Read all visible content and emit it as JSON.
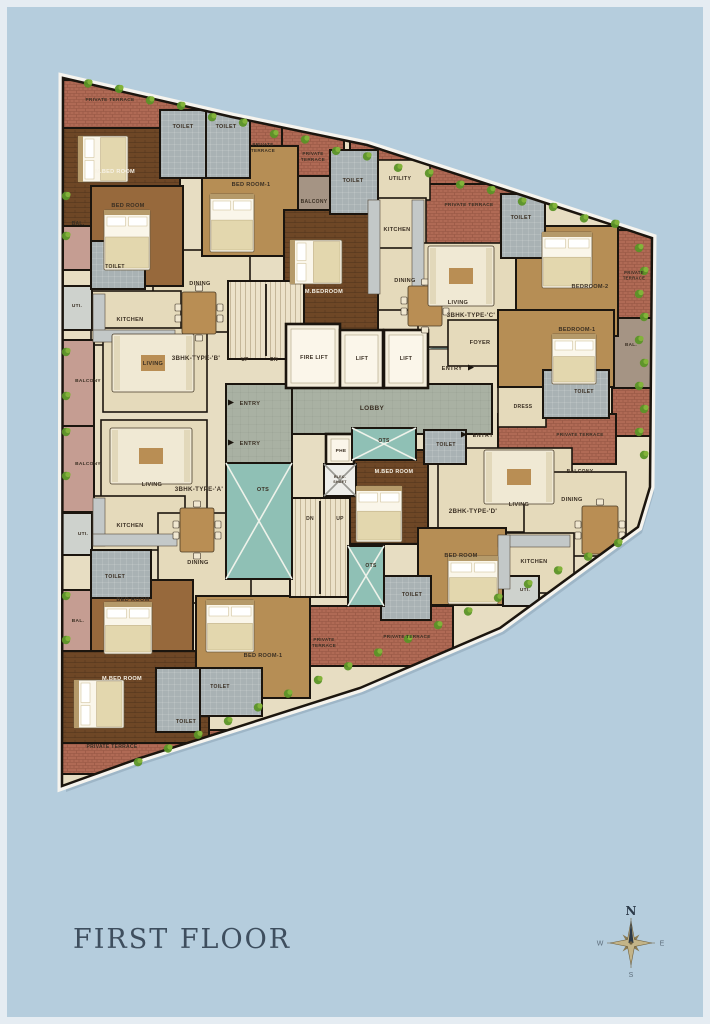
{
  "title": "FIRST FLOOR",
  "entry_label": "ENTRY",
  "compass": {
    "n": "N",
    "e": "E",
    "s": "S",
    "w": "W"
  },
  "colors": {
    "bg": "#b5cddd",
    "frame": "#e5ecf2",
    "slab": "#f6f4ee",
    "wall": "#1b150e",
    "base": "#e7ddc2",
    "terrace": "#b06a55",
    "terraceLine": "#935341",
    "toilet": "#a9b2b4",
    "lobby": "#a9b1a3",
    "lift": "#f4eddb",
    "ots": "#8fc0b5",
    "shaft": "#eeeeea",
    "stairs": "#ece2c9",
    "floor": "#e5dabb",
    "tan": "#b68e55",
    "brown": "#97693c",
    "wood": "#6e4726",
    "balc": "#c59d92",
    "balc2": "#a59484",
    "uti": "#ced2cd",
    "counter": "#c3c8c8",
    "mat": "#9fc8c0",
    "text": "#3a2f23",
    "textLight": "#f7f2e6",
    "title": "#3e4e5e",
    "green1": "#5b9427",
    "green2": "#83b33a",
    "compassStar": "#c3b488",
    "compassStar2": "#8a7a52",
    "compassDark": "#2c3a49",
    "compassSmall": "#5d6d7b"
  },
  "plan": {
    "outline": [
      [
        63,
        78
      ],
      [
        232,
        117
      ],
      [
        367,
        145
      ],
      [
        512,
        192
      ],
      [
        652,
        238
      ],
      [
        650,
        487
      ],
      [
        638,
        527
      ],
      [
        500,
        628
      ],
      [
        360,
        688
      ],
      [
        140,
        758
      ],
      [
        62,
        786
      ]
    ],
    "rooms": [
      [
        "terrace-top-left",
        "terrace",
        62,
        80,
        200,
        50
      ],
      [
        "terrace-top-2",
        "terrace",
        236,
        116,
        54,
        66
      ],
      [
        "terrace-top-3",
        "terrace",
        282,
        122,
        62,
        60
      ],
      [
        "terrace-top-mid",
        "terrace",
        350,
        135,
        175,
        60
      ],
      [
        "terrace-c",
        "terrace",
        424,
        184,
        96,
        60
      ],
      [
        "terrace-right-1",
        "terrace",
        614,
        230,
        38,
        92
      ],
      [
        "terrace-right-2",
        "terrace",
        612,
        386,
        40,
        50
      ],
      [
        "terrace-mid-right",
        "terrace",
        498,
        414,
        118,
        50
      ],
      [
        "terrace-bottom-center",
        "terrace",
        288,
        606,
        165,
        60
      ],
      [
        "terrace-bottom-left",
        "terrace",
        62,
        730,
        185,
        44
      ],
      [
        "lobby-main",
        "lobby",
        226,
        384,
        266,
        50
      ],
      [
        "lobby-left",
        "lobby",
        226,
        384,
        66,
        132
      ],
      [
        "entry-mat",
        "mat",
        428,
        336,
        34,
        13
      ],
      [
        "dining-b",
        "floor",
        153,
        250,
        97,
        82
      ],
      [
        "kitchen-b",
        "floor",
        91,
        291,
        90,
        54
      ],
      [
        "living-b",
        "floor",
        103,
        328,
        104,
        84
      ],
      [
        "balcony-b",
        "balc2",
        286,
        176,
        60,
        54
      ],
      [
        "utility-c",
        "floor",
        366,
        160,
        64,
        40
      ],
      [
        "kitchen-c",
        "floor",
        366,
        198,
        60,
        100
      ],
      [
        "dining-c",
        "floor",
        376,
        248,
        62,
        62
      ],
      [
        "living-c",
        "floor",
        418,
        243,
        104,
        104
      ],
      [
        "foyer-c",
        "floor",
        448,
        320,
        66,
        46
      ],
      [
        "dress-c",
        "floor",
        498,
        385,
        48,
        42
      ],
      [
        "living-d",
        "floor",
        438,
        448,
        134,
        84
      ],
      [
        "dining-d",
        "floor",
        524,
        472,
        102,
        84
      ],
      [
        "kitchen-d",
        "floor",
        496,
        533,
        78,
        60
      ],
      [
        "living-a",
        "floor",
        101,
        420,
        106,
        90
      ],
      [
        "kitchen-a",
        "floor",
        91,
        496,
        94,
        54
      ],
      [
        "dining-a",
        "floor",
        158,
        513,
        93,
        90
      ],
      [
        "bal-b",
        "balc",
        62,
        190,
        30,
        80
      ],
      [
        "balcony-left-1",
        "balc",
        62,
        340,
        32,
        86
      ],
      [
        "balcony-left-2",
        "balc",
        62,
        426,
        32,
        86
      ],
      [
        "bal-a",
        "balc",
        62,
        590,
        30,
        74
      ],
      [
        "bal-right",
        "balc2",
        612,
        318,
        40,
        70
      ],
      [
        "mbed-b",
        "wood",
        62,
        128,
        118,
        98
      ],
      [
        "bed1-b",
        "tan",
        202,
        146,
        96,
        110
      ],
      [
        "bed-b",
        "brown",
        91,
        186,
        92,
        100
      ],
      [
        "mbed-c",
        "wood",
        284,
        210,
        94,
        120
      ],
      [
        "bed2-c",
        "tan",
        516,
        226,
        102,
        110
      ],
      [
        "bed1-c",
        "tan",
        498,
        310,
        116,
        77
      ],
      [
        "mbed-d",
        "wood",
        350,
        450,
        78,
        94
      ],
      [
        "bed-d",
        "tan",
        418,
        528,
        88,
        77
      ],
      [
        "bed-a",
        "brown",
        91,
        580,
        102,
        87
      ],
      [
        "mbed-a",
        "wood",
        62,
        651,
        147,
        92
      ],
      [
        "bed1-a",
        "tan",
        196,
        596,
        114,
        102
      ],
      [
        "uti-b",
        "uti",
        62,
        286,
        30,
        44
      ],
      [
        "uti-a",
        "uti",
        62,
        513,
        30,
        42
      ],
      [
        "uti-d",
        "uti",
        503,
        576,
        36,
        30
      ],
      [
        "toilet-b1",
        "toilet",
        160,
        110,
        46,
        68
      ],
      [
        "toilet-b2",
        "toilet",
        206,
        110,
        44,
        68
      ],
      [
        "toilet-c1",
        "toilet",
        330,
        150,
        48,
        64
      ],
      [
        "toilet-b4",
        "toilet",
        91,
        241,
        54,
        48
      ],
      [
        "toilet-c2",
        "toilet",
        501,
        194,
        44,
        64
      ],
      [
        "toilet-c3",
        "toilet",
        543,
        370,
        66,
        48
      ],
      [
        "toilet-mid",
        "toilet",
        424,
        430,
        42,
        34
      ],
      [
        "toilet-d",
        "toilet",
        381,
        576,
        50,
        44
      ],
      [
        "toilet-a",
        "toilet",
        91,
        550,
        60,
        48
      ],
      [
        "toilet-a2",
        "toilet",
        196,
        668,
        66,
        48
      ],
      [
        "toilet-a3",
        "toilet",
        156,
        668,
        44,
        64
      ],
      [
        "stairs-top",
        "stairs",
        228,
        281,
        76,
        78
      ],
      [
        "stairs-bottom",
        "stairs",
        290,
        498,
        60,
        99
      ],
      [
        "fire-lift",
        "lift",
        286,
        324,
        54,
        64
      ],
      [
        "lift-1",
        "lift",
        340,
        330,
        43,
        58
      ],
      [
        "lift-2",
        "lift",
        384,
        330,
        44,
        58
      ],
      [
        "phe-room",
        "lift",
        326,
        434,
        28,
        32
      ],
      [
        "elec-shaft",
        "shaft",
        324,
        464,
        32,
        32
      ],
      [
        "ots-top",
        "ots",
        352,
        428,
        64,
        32
      ],
      [
        "ots-small",
        "ots",
        348,
        546,
        36,
        60
      ],
      [
        "ots-big",
        "ots",
        226,
        463,
        66,
        116
      ],
      [
        "counter",
        "counter",
        93,
        294,
        12,
        48
      ],
      [
        "counter",
        "counter",
        93,
        330,
        82,
        12
      ],
      [
        "counter",
        "counter",
        368,
        200,
        12,
        94
      ],
      [
        "counter",
        "counter",
        412,
        200,
        12,
        94
      ],
      [
        "counter",
        "counter",
        93,
        498,
        12,
        48
      ],
      [
        "counter",
        "counter",
        93,
        534,
        84,
        12
      ],
      [
        "counter",
        "counter",
        498,
        535,
        72,
        12
      ],
      [
        "counter",
        "counter",
        498,
        535,
        12,
        54
      ]
    ],
    "furniture": [
      [
        "bed",
        78,
        136,
        50,
        46,
        "h"
      ],
      [
        "bed",
        210,
        194,
        44,
        58,
        "v"
      ],
      [
        "bed",
        104,
        210,
        46,
        60,
        "v"
      ],
      [
        "bed",
        290,
        240,
        52,
        44,
        "h"
      ],
      [
        "bed",
        542,
        232,
        50,
        56,
        "v"
      ],
      [
        "bed",
        552,
        334,
        44,
        50,
        "v"
      ],
      [
        "bed",
        356,
        486,
        46,
        56,
        "v"
      ],
      [
        "bed",
        448,
        556,
        50,
        48,
        "v"
      ],
      [
        "bed",
        104,
        602,
        48,
        52,
        "v"
      ],
      [
        "bed",
        74,
        680,
        50,
        48,
        "h"
      ],
      [
        "bed",
        206,
        600,
        48,
        52,
        "v"
      ],
      [
        "table",
        182,
        292,
        34,
        42
      ],
      [
        "table",
        408,
        286,
        34,
        40
      ],
      [
        "table",
        582,
        506,
        36,
        48
      ],
      [
        "table",
        180,
        508,
        34,
        44
      ],
      [
        "sofa",
        112,
        334,
        82,
        58
      ],
      [
        "sofa",
        110,
        428,
        82,
        56
      ],
      [
        "sofa",
        428,
        246,
        66,
        60
      ],
      [
        "sofa",
        484,
        450,
        70,
        54
      ]
    ],
    "texts": [
      [
        "PRIVATE TERRACE",
        110,
        101,
        4.8
      ],
      [
        "TOILET",
        183,
        128,
        5.4
      ],
      [
        "TOILET",
        226,
        128,
        5.4
      ],
      [
        "PRIVATE TERRACE",
        263,
        146,
        4.6,
        "2"
      ],
      [
        "PRIVATE TERRACE",
        313,
        155,
        4.6,
        "2"
      ],
      [
        "M.BED ROOM",
        115,
        173,
        5.6,
        "w"
      ],
      [
        "BED ROOM-1",
        251,
        186,
        5.6
      ],
      [
        "BED ROOM",
        128,
        207,
        5.6
      ],
      [
        "BAL.",
        78,
        225,
        5.0
      ],
      [
        "BALCONY",
        314,
        203,
        5.0
      ],
      [
        "TOILET",
        353,
        182,
        5.4
      ],
      [
        "TOILET",
        115,
        268,
        5.0
      ],
      [
        "UTI.",
        77,
        307,
        4.8
      ],
      [
        "KITCHEN",
        130,
        321,
        5.6
      ],
      [
        "DINING",
        200,
        285,
        5.6
      ],
      [
        "LIVING",
        153,
        365,
        5.6
      ],
      [
        "3BHK-TYPE-'B'",
        196,
        360,
        6.2
      ],
      [
        "BALCONY",
        88,
        382,
        4.8
      ],
      [
        "BALCONY",
        88,
        465,
        4.8
      ],
      [
        "UTILITY",
        400,
        180,
        5.4
      ],
      [
        "KITCHEN",
        397,
        231,
        5.6
      ],
      [
        "PRIVATE TERRACE",
        469,
        206,
        4.8
      ],
      [
        "TOILET",
        521,
        219,
        5.4
      ],
      [
        "DINING",
        405,
        282,
        5.6
      ],
      [
        "LIVING",
        458,
        304,
        5.6
      ],
      [
        "3BHK-TYPE-'C'",
        471,
        317,
        6.2
      ],
      [
        "M.BEDROOM",
        324,
        293,
        5.6,
        "w"
      ],
      [
        "BEDROOM-2",
        590,
        288,
        5.6
      ],
      [
        "PRIVATE TERRACE",
        634,
        274,
        4.2,
        "2"
      ],
      [
        "FOYER",
        480,
        344,
        5.6
      ],
      [
        "BEDROOM-1",
        577,
        331,
        5.6
      ],
      [
        "BAL.",
        631,
        346,
        4.6
      ],
      [
        "TOILET",
        584,
        393,
        5.0
      ],
      [
        "DRESS",
        523,
        408,
        5.0
      ],
      [
        "PRIVATE TERRACE",
        580,
        436,
        4.6
      ],
      [
        "BALCONY",
        580,
        473,
        5.0
      ],
      [
        "UP",
        245,
        361,
        5.0
      ],
      [
        "DN",
        274,
        361,
        5.0
      ],
      [
        "FIRE LIFT",
        314,
        359,
        5.4
      ],
      [
        "LIFT",
        362,
        360,
        5.4
      ],
      [
        "LIFT",
        406,
        360,
        5.4
      ],
      [
        "LOBBY",
        372,
        410,
        6.5
      ],
      [
        "PHE",
        341,
        452,
        4.8
      ],
      [
        "ELEC. SHAFT",
        340,
        478,
        3.6,
        "2"
      ],
      [
        "OTS",
        384,
        442,
        5.0
      ],
      [
        "TOILET",
        446,
        446,
        5.0
      ],
      [
        "M.BED ROOM",
        394,
        473,
        5.4,
        "w"
      ],
      [
        "DN",
        310,
        520,
        5.0
      ],
      [
        "UP",
        340,
        520,
        5.0
      ],
      [
        "OTS",
        263,
        491,
        5.5
      ],
      [
        "OTS",
        371,
        567,
        5.0
      ],
      [
        "TOILET",
        412,
        596,
        5.2
      ],
      [
        "2BHK-TYPE-'D'",
        473,
        513,
        6.2
      ],
      [
        "LIVING",
        519,
        506,
        5.6
      ],
      [
        "DINING",
        572,
        501,
        5.6
      ],
      [
        "KITCHEN",
        534,
        563,
        5.6
      ],
      [
        "UTI.",
        525,
        591,
        4.8
      ],
      [
        "BED ROOM",
        461,
        557,
        5.6
      ],
      [
        "PRIVATE TERRACE",
        407,
        638,
        4.6
      ],
      [
        "PRIVATE TERRACE",
        324,
        641,
        4.6,
        "2"
      ],
      [
        "LIVING",
        152,
        486,
        5.6
      ],
      [
        "3BHK-TYPE-'A'",
        199,
        491,
        6.2
      ],
      [
        "KITCHEN",
        130,
        527,
        5.6
      ],
      [
        "UTI.",
        83,
        535,
        4.8
      ],
      [
        "DINING",
        198,
        564,
        5.6
      ],
      [
        "TOILET",
        115,
        578,
        5.2
      ],
      [
        "BED ROOM",
        133,
        601,
        5.6
      ],
      [
        "BAL.",
        78,
        622,
        4.8
      ],
      [
        "BED ROOM-1",
        263,
        657,
        5.6
      ],
      [
        "M.BED ROOM",
        122,
        680,
        5.6,
        "w"
      ],
      [
        "TOILET",
        220,
        688,
        5.0
      ],
      [
        "TOILET",
        186,
        723,
        5.2
      ],
      [
        "PRIVATE TERRACE",
        112,
        748,
        5.0
      ]
    ],
    "entries": [
      [
        452,
        370,
        "r"
      ],
      [
        250,
        405,
        "l"
      ],
      [
        250,
        445,
        "l"
      ],
      [
        483,
        437,
        "l"
      ]
    ]
  }
}
